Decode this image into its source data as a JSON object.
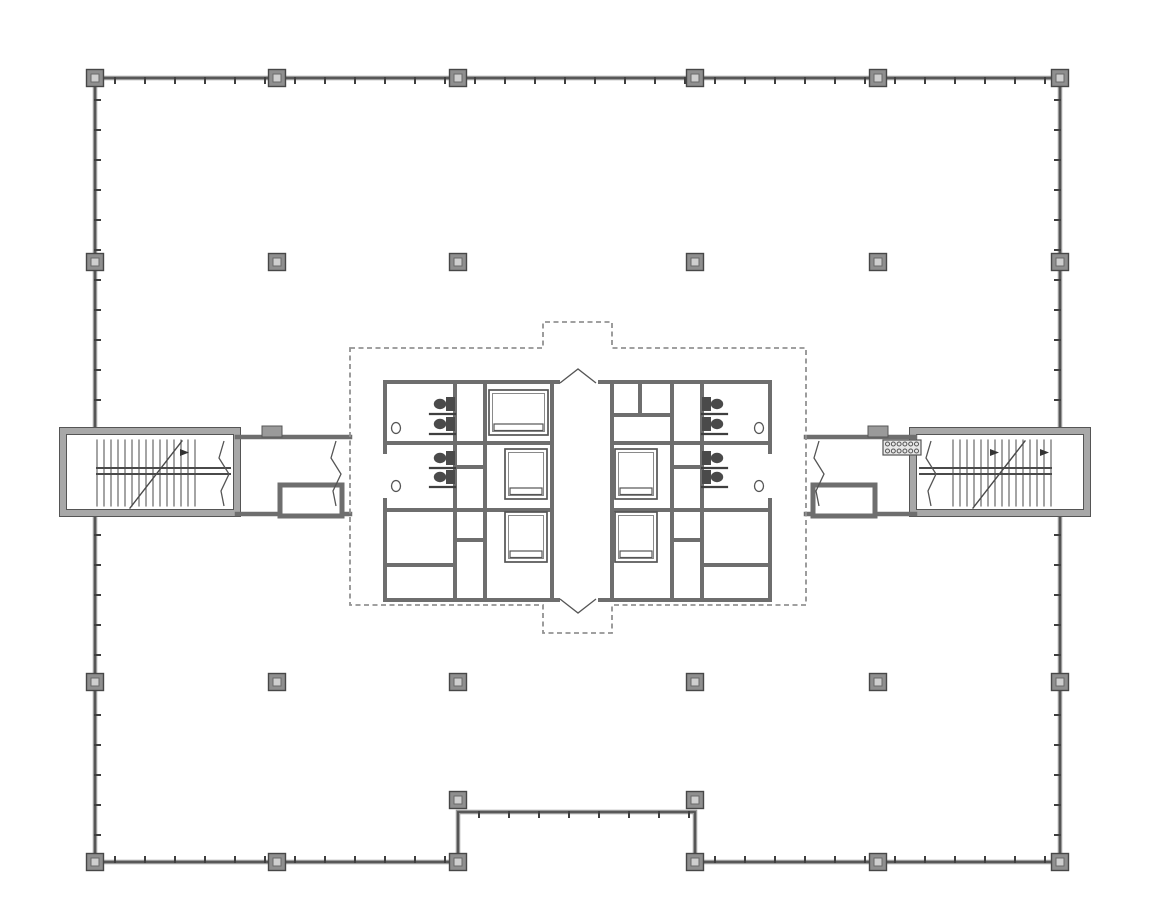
{
  "page": {
    "title": "Architectural floor plan — office tower typical floor with central core, elevator banks, restrooms and two exit stairs",
    "background": "#ffffff"
  },
  "colors": {
    "wall_dark": "#4f4f4f",
    "wall_gray": "#9a9a9a",
    "core_wall": "#6e6e6e",
    "stair_wall": "#a8a8a8",
    "column_fill": "#8f8f8f",
    "column_stroke": "#474747",
    "column_inner": "#cfcfcf",
    "dashed": "#929292",
    "thin": "#555555",
    "fixture": "#4a4a4a",
    "grille_fill": "#e8e8e8"
  },
  "plan": {
    "canvas": {
      "w": 1150,
      "h": 916
    },
    "perimeter": {
      "outline": [
        [
          95,
          78
        ],
        [
          1060,
          78
        ],
        [
          1060,
          862
        ],
        [
          695,
          862
        ],
        [
          695,
          812
        ],
        [
          458,
          812
        ],
        [
          458,
          862
        ],
        [
          95,
          862
        ]
      ],
      "mullion_spacing": 30,
      "mullion_len": 5,
      "mullion_segments": [
        {
          "x1": 100,
          "y1": 78,
          "x2": 1055,
          "y2": 78,
          "nx": 0,
          "ny": 1
        },
        {
          "x1": 95,
          "y1": 85,
          "x2": 95,
          "y2": 425,
          "nx": 1,
          "ny": 0
        },
        {
          "x1": 95,
          "y1": 520,
          "x2": 95,
          "y2": 855,
          "nx": 1,
          "ny": 0
        },
        {
          "x1": 1060,
          "y1": 85,
          "x2": 1060,
          "y2": 425,
          "nx": -1,
          "ny": 0
        },
        {
          "x1": 1060,
          "y1": 520,
          "x2": 1060,
          "y2": 855,
          "nx": -1,
          "ny": 0
        },
        {
          "x1": 100,
          "y1": 862,
          "x2": 452,
          "y2": 862,
          "nx": 0,
          "ny": -1
        },
        {
          "x1": 700,
          "y1": 862,
          "x2": 1055,
          "y2": 862,
          "nx": 0,
          "ny": -1
        },
        {
          "x1": 464,
          "y1": 812,
          "x2": 690,
          "y2": 812,
          "nx": 0,
          "ny": 1
        }
      ]
    },
    "columns": {
      "size": 17,
      "inner": 8,
      "positions": [
        [
          95,
          78
        ],
        [
          277,
          78
        ],
        [
          458,
          78
        ],
        [
          695,
          78
        ],
        [
          878,
          78
        ],
        [
          1060,
          78
        ],
        [
          95,
          262
        ],
        [
          277,
          262
        ],
        [
          458,
          262
        ],
        [
          695,
          262
        ],
        [
          878,
          262
        ],
        [
          1060,
          262
        ],
        [
          95,
          682
        ],
        [
          277,
          682
        ],
        [
          458,
          682
        ],
        [
          695,
          682
        ],
        [
          878,
          682
        ],
        [
          1060,
          682
        ],
        [
          95,
          862
        ],
        [
          277,
          862
        ],
        [
          458,
          862
        ],
        [
          695,
          862
        ],
        [
          878,
          862
        ],
        [
          1060,
          862
        ],
        [
          458,
          800
        ],
        [
          695,
          800
        ]
      ]
    },
    "stairs": {
      "left": {
        "box": [
          63,
          431,
          174,
          82
        ],
        "treads": {
          "x0": 97,
          "x1": 196,
          "step": 7,
          "y0": 440,
          "y1": 506
        },
        "rails": [
          [
            97,
            468,
            230,
            468
          ],
          [
            97,
            474,
            230,
            474
          ]
        ],
        "diagonal": [
          130,
          508,
          182,
          441
        ],
        "arrows": [
          [
            180,
            449,
            180,
            456,
            189,
            452.5
          ]
        ]
      },
      "right": {
        "box": [
          913,
          431,
          174,
          82
        ],
        "treads": {
          "x0": 953,
          "x1": 1052,
          "step": 7,
          "y0": 440,
          "y1": 506
        },
        "rails": [
          [
            920,
            468,
            1051,
            468
          ],
          [
            920,
            474,
            1051,
            474
          ]
        ],
        "diagonal": [
          973,
          508,
          1025,
          441
        ],
        "arrows": [
          [
            990,
            449,
            990,
            456,
            999,
            452.5
          ],
          [
            1040,
            449,
            1040,
            456,
            1049,
            452.5
          ]
        ]
      }
    },
    "corridors": {
      "walls": [
        [
          237,
          437,
          350,
          437
        ],
        [
          237,
          514,
          350,
          514
        ],
        [
          806,
          437,
          915,
          437
        ],
        [
          806,
          514,
          915,
          514
        ]
      ],
      "vestibules": [
        [
          280,
          485,
          62,
          31
        ],
        [
          813,
          485,
          62,
          31
        ]
      ],
      "pilasters": [
        [
          262,
          426,
          20,
          11
        ],
        [
          868,
          426,
          20,
          11
        ]
      ],
      "breaks": [
        {
          "pts": [
            [
              224,
              441
            ],
            [
              219,
              458
            ],
            [
              229,
              474
            ],
            [
              221,
              491
            ],
            [
              224,
              506
            ]
          ]
        },
        {
          "pts": [
            [
              336,
              441
            ],
            [
              331,
              458
            ],
            [
              341,
              474
            ],
            [
              333,
              491
            ],
            [
              336,
              506
            ]
          ]
        },
        {
          "pts": [
            [
              819,
              441
            ],
            [
              814,
              458
            ],
            [
              824,
              474
            ],
            [
              816,
              491
            ],
            [
              819,
              506
            ]
          ]
        },
        {
          "pts": [
            [
              931,
              441
            ],
            [
              926,
              458
            ],
            [
              936,
              474
            ],
            [
              928,
              491
            ],
            [
              931,
              506
            ]
          ]
        }
      ]
    },
    "core": {
      "boundary": [
        [
          350,
          348
        ],
        [
          543,
          348
        ],
        [
          543,
          322
        ],
        [
          612,
          322
        ],
        [
          612,
          348
        ],
        [
          806,
          348
        ],
        [
          806,
          605
        ],
        [
          612,
          605
        ],
        [
          612,
          633
        ],
        [
          543,
          633
        ],
        [
          543,
          605
        ],
        [
          350,
          605
        ]
      ],
      "walls": [
        [
          385,
          382,
          558,
          382
        ],
        [
          600,
          382,
          770,
          382
        ],
        [
          385,
          600,
          558,
          600
        ],
        [
          600,
          600,
          770,
          600
        ],
        [
          385,
          382,
          385,
          452
        ],
        [
          385,
          500,
          385,
          600
        ],
        [
          770,
          382,
          770,
          452
        ],
        [
          770,
          500,
          770,
          600
        ],
        [
          455,
          382,
          455,
          600
        ],
        [
          485,
          382,
          485,
          600
        ],
        [
          552,
          382,
          552,
          600
        ],
        [
          612,
          382,
          612,
          600
        ],
        [
          672,
          382,
          672,
          600
        ],
        [
          702,
          382,
          702,
          600
        ],
        [
          385,
          443,
          552,
          443
        ],
        [
          385,
          510,
          552,
          510
        ],
        [
          385,
          565,
          455,
          565
        ],
        [
          612,
          443,
          770,
          443
        ],
        [
          612,
          510,
          770,
          510
        ],
        [
          702,
          565,
          770,
          565
        ],
        [
          612,
          415,
          672,
          415
        ],
        [
          640,
          382,
          640,
          415
        ],
        [
          455,
          467,
          485,
          467
        ],
        [
          455,
          540,
          485,
          540
        ],
        [
          672,
          467,
          702,
          467
        ],
        [
          672,
          540,
          702,
          540
        ]
      ],
      "elevators": [
        {
          "rect": [
            489,
            390,
            59,
            45
          ]
        },
        {
          "rect": [
            505,
            449,
            42,
            50
          ]
        },
        {
          "rect": [
            505,
            512,
            42,
            50
          ]
        },
        {
          "rect": [
            615,
            449,
            42,
            50
          ]
        },
        {
          "rect": [
            615,
            512,
            42,
            50
          ]
        }
      ],
      "toilets": [
        {
          "x": 455,
          "y": 404,
          "dir": "L"
        },
        {
          "x": 455,
          "y": 424,
          "dir": "L"
        },
        {
          "x": 455,
          "y": 458,
          "dir": "L"
        },
        {
          "x": 455,
          "y": 477,
          "dir": "L"
        },
        {
          "x": 702,
          "y": 404,
          "dir": "R"
        },
        {
          "x": 702,
          "y": 424,
          "dir": "R"
        },
        {
          "x": 702,
          "y": 458,
          "dir": "R"
        },
        {
          "x": 702,
          "y": 477,
          "dir": "R"
        }
      ],
      "sinks": [
        [
          396,
          428
        ],
        [
          396,
          486
        ],
        [
          759,
          428
        ],
        [
          759,
          486
        ]
      ],
      "stalls": [
        [
          430,
          414,
          455,
          414
        ],
        [
          430,
          434,
          455,
          434
        ],
        [
          430,
          468,
          455,
          468
        ],
        [
          430,
          487,
          455,
          487
        ],
        [
          702,
          414,
          727,
          414
        ],
        [
          702,
          434,
          727,
          434
        ],
        [
          702,
          468,
          727,
          468
        ],
        [
          702,
          487,
          727,
          487
        ]
      ],
      "grille": {
        "x": 883,
        "y": 440,
        "w": 38,
        "h": 15,
        "rows": 2,
        "cols": 6,
        "r": 2
      },
      "chevrons": [
        {
          "pts": [
            [
              560,
              383
            ],
            [
              578,
              369
            ],
            [
              596,
              383
            ]
          ]
        },
        {
          "pts": [
            [
              560,
              599
            ],
            [
              578,
              613
            ],
            [
              596,
              599
            ]
          ]
        }
      ]
    }
  }
}
